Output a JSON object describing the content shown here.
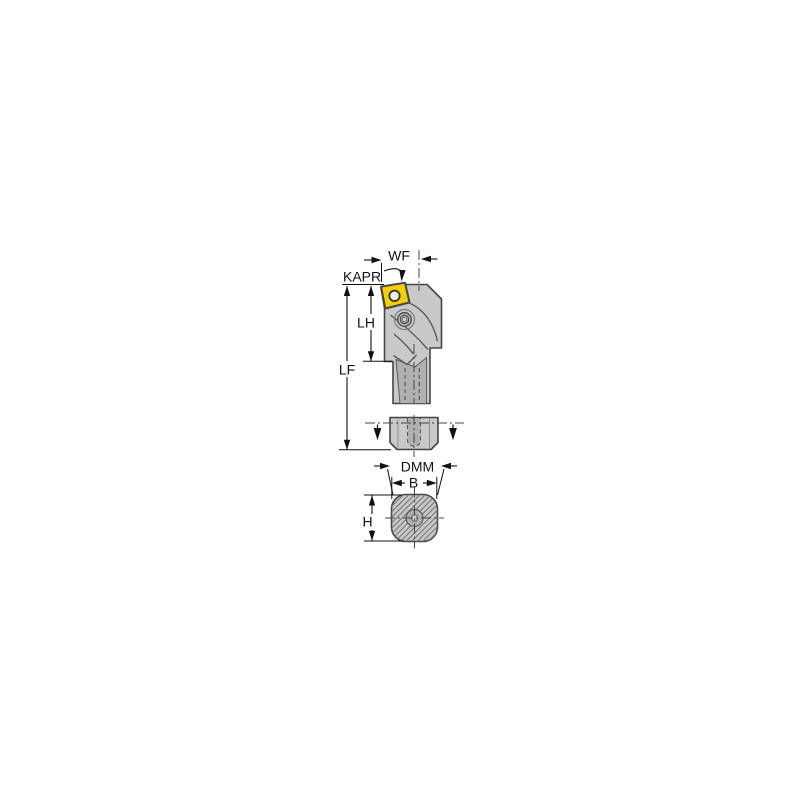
{
  "figure": {
    "dim_labels": {
      "wf": "WF",
      "kapr": "KAPR",
      "lh": "LH",
      "lf": "LF",
      "dmm": "DMM",
      "b": "B",
      "h": "H"
    },
    "colors": {
      "insert": "#f3cf06",
      "body": "#c9c9c9",
      "body_shadow": "#b0b0b0",
      "screw": "#bdbdbd",
      "outline": "#454545",
      "detail_line": "#5a5a5a",
      "hatch": "#777777",
      "dimension": "#111111",
      "background": "#ffffff"
    }
  }
}
